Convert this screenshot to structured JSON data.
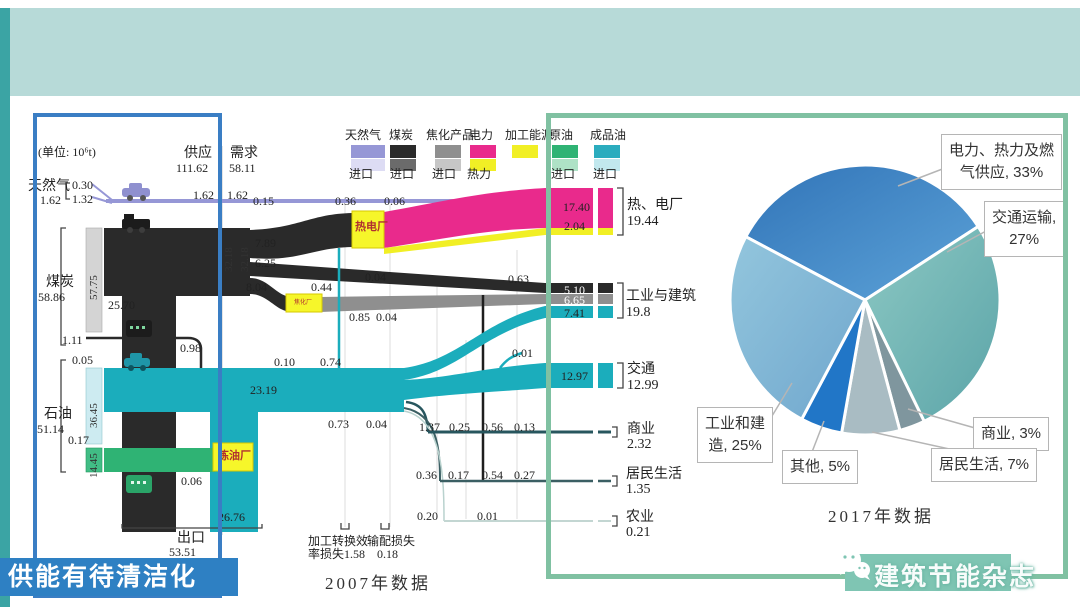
{
  "header": {
    "title": "上海市碳排放组成",
    "nav": {
      "item1": "组成",
      "item2": "产能",
      "item3": "节能",
      "sep": "/"
    },
    "logo": {
      "en": "Shanghai",
      "zh": "上海"
    }
  },
  "footer": {
    "left_badge": "供能有待清洁化",
    "watermark": "建筑节能杂志"
  },
  "sankey": {
    "unit": "(单位: 10⁶t)",
    "caption": "2007年数据",
    "supply": {
      "label": "供应",
      "value": "111.62"
    },
    "demand": {
      "label": "需求",
      "value": "58.11"
    },
    "legend": [
      {
        "name": "天然气",
        "sub": "进口"
      },
      {
        "name": "煤炭",
        "sub": "进口"
      },
      {
        "name": "焦化产品",
        "sub": "进口"
      },
      {
        "name": "电力",
        "sub": "热力"
      },
      {
        "name": "加工能源",
        "sub": ""
      },
      {
        "name": "原油",
        "sub": "进口"
      },
      {
        "name": "成品油",
        "sub": "进口"
      }
    ],
    "sources": {
      "gas": {
        "name": "天然气",
        "total": "1.62",
        "a": "0.30",
        "b": "1.32"
      },
      "coal": {
        "name": "煤炭",
        "total": "58.86",
        "bar": "57.75",
        "a": "1.11",
        "b": "0.98",
        "c": "25.70"
      },
      "oil": {
        "name": "石油",
        "total": "51.14",
        "bar1": "36.45",
        "bar2": "14.45",
        "a": "0.05",
        "b": "0.17"
      }
    },
    "plants": {
      "chp": "热电厂",
      "refinery": "炼油厂",
      "coking": "焦化厂"
    },
    "flows": {
      "gas1": "1.62",
      "gas2": "1.62",
      "f015": "0.15",
      "f036": "0.36",
      "f006": "0.06",
      "f789": "7.89",
      "f625": "6.25",
      "f804": "8.04",
      "f044": "0.44",
      "f004a": "0.04",
      "f063": "0.63",
      "f085": "0.85",
      "f004b": "0.04",
      "v1": "32.18",
      "v2": "32.18",
      "f2319": "23.19",
      "f010": "0.10",
      "f074": "0.74",
      "f073": "0.73",
      "f004c": "0.04",
      "f137": "1.37",
      "f025": "0.25",
      "f056": "0.56",
      "f013": "0.13",
      "f036b": "0.36",
      "f017": "0.17",
      "f054": "0.54",
      "f027": "0.27",
      "f020": "0.20",
      "f001a": "0.01",
      "f001b": "0.01",
      "f006b": "0.06",
      "f2676": "26.76"
    },
    "export": {
      "label": "出口",
      "value": "53.51"
    },
    "losses": {
      "l1a": "加工转换效",
      "l1b": "率损失1.58",
      "l2a": "输配损失",
      "l2b": "0.18"
    },
    "sinks": [
      {
        "name": "热、电厂",
        "total": "19.44",
        "p1": "17.40",
        "p2": "2.04"
      },
      {
        "name": "工业与建筑",
        "total": "19.8",
        "p1": "5.10",
        "p2": "6.65",
        "p3": "7.41"
      },
      {
        "name": "交通",
        "total": "12.99",
        "p1": "12.97"
      },
      {
        "name": "商业",
        "total": "2.32"
      },
      {
        "name": "居民生活",
        "total": "1.35"
      },
      {
        "name": "农业",
        "total": "0.21"
      }
    ]
  },
  "pie": {
    "caption": "2017年数据",
    "boxes": {
      "power1": "电力、热力及燃",
      "power2": "气供应, 33%",
      "transport1": "交通运输,",
      "transport2": "27%",
      "commerce": "商业, 3%",
      "residential": "居民生活, 7%",
      "other": "其他, 5%",
      "industry1": "工业和建",
      "industry2": "造, 25%"
    }
  },
  "chart_data": [
    {
      "type": "sankey",
      "title": "2007年数据",
      "unit": "10^6 t",
      "supply_total": 111.62,
      "demand_total": 58.11,
      "sources": [
        {
          "name": "天然气",
          "total": 1.62,
          "imports": [
            0.3,
            1.32
          ]
        },
        {
          "name": "煤炭",
          "total": 58.86,
          "domestic_bar": 57.75,
          "branch_values": [
            25.7,
            1.11,
            0.98
          ]
        },
        {
          "name": "石油",
          "total": 51.14,
          "refined_import_bar": 36.45,
          "crude_import_bar": 14.45,
          "branch_values": [
            0.05,
            0.17
          ]
        }
      ],
      "transformers": [
        "热电厂",
        "炼油厂",
        "焦化厂"
      ],
      "intermediate_values": [
        1.62,
        1.62,
        0.15,
        0.36,
        0.06,
        7.89,
        6.25,
        8.04,
        0.44,
        0.04,
        0.63,
        0.85,
        0.04,
        32.18,
        32.18,
        23.19,
        0.1,
        0.74,
        0.73,
        0.04,
        0.01,
        0.01
      ],
      "sinks": [
        {
          "name": "热、电厂",
          "total": 19.44,
          "parts": [
            17.4,
            2.04
          ]
        },
        {
          "name": "工业与建筑",
          "total": 19.8,
          "parts": [
            5.1,
            6.65,
            7.41
          ]
        },
        {
          "name": "交通",
          "total": 12.99,
          "parts": [
            12.97
          ]
        },
        {
          "name": "商业",
          "total": 2.32,
          "parts": [
            1.37,
            0.25,
            0.56,
            0.13
          ]
        },
        {
          "name": "居民生活",
          "total": 1.35,
          "parts": [
            0.36,
            0.17,
            0.54,
            0.27
          ]
        },
        {
          "name": "农业",
          "total": 0.21,
          "parts": [
            0.2,
            0.01
          ]
        }
      ],
      "export": {
        "name": "出口",
        "total": 53.51,
        "refined_part": 26.76,
        "other_part": 0.06
      },
      "losses": [
        {
          "name": "加工转换效率损失",
          "value": 1.58
        },
        {
          "name": "输配损失",
          "value": 0.18
        }
      ]
    },
    {
      "type": "pie",
      "title": "2017年数据",
      "labels": [
        "电力、热力及燃气供应",
        "交通运输",
        "商业",
        "居民生活",
        "其他",
        "工业和建造"
      ],
      "values": [
        33,
        27,
        3,
        7,
        5,
        25
      ],
      "colors": [
        "#4487c6",
        "#72b4b3",
        "#7f969e",
        "#a9bcc3",
        "#2176c7",
        "#7fb2d6"
      ],
      "legend_position": "callout-boxes"
    }
  ]
}
